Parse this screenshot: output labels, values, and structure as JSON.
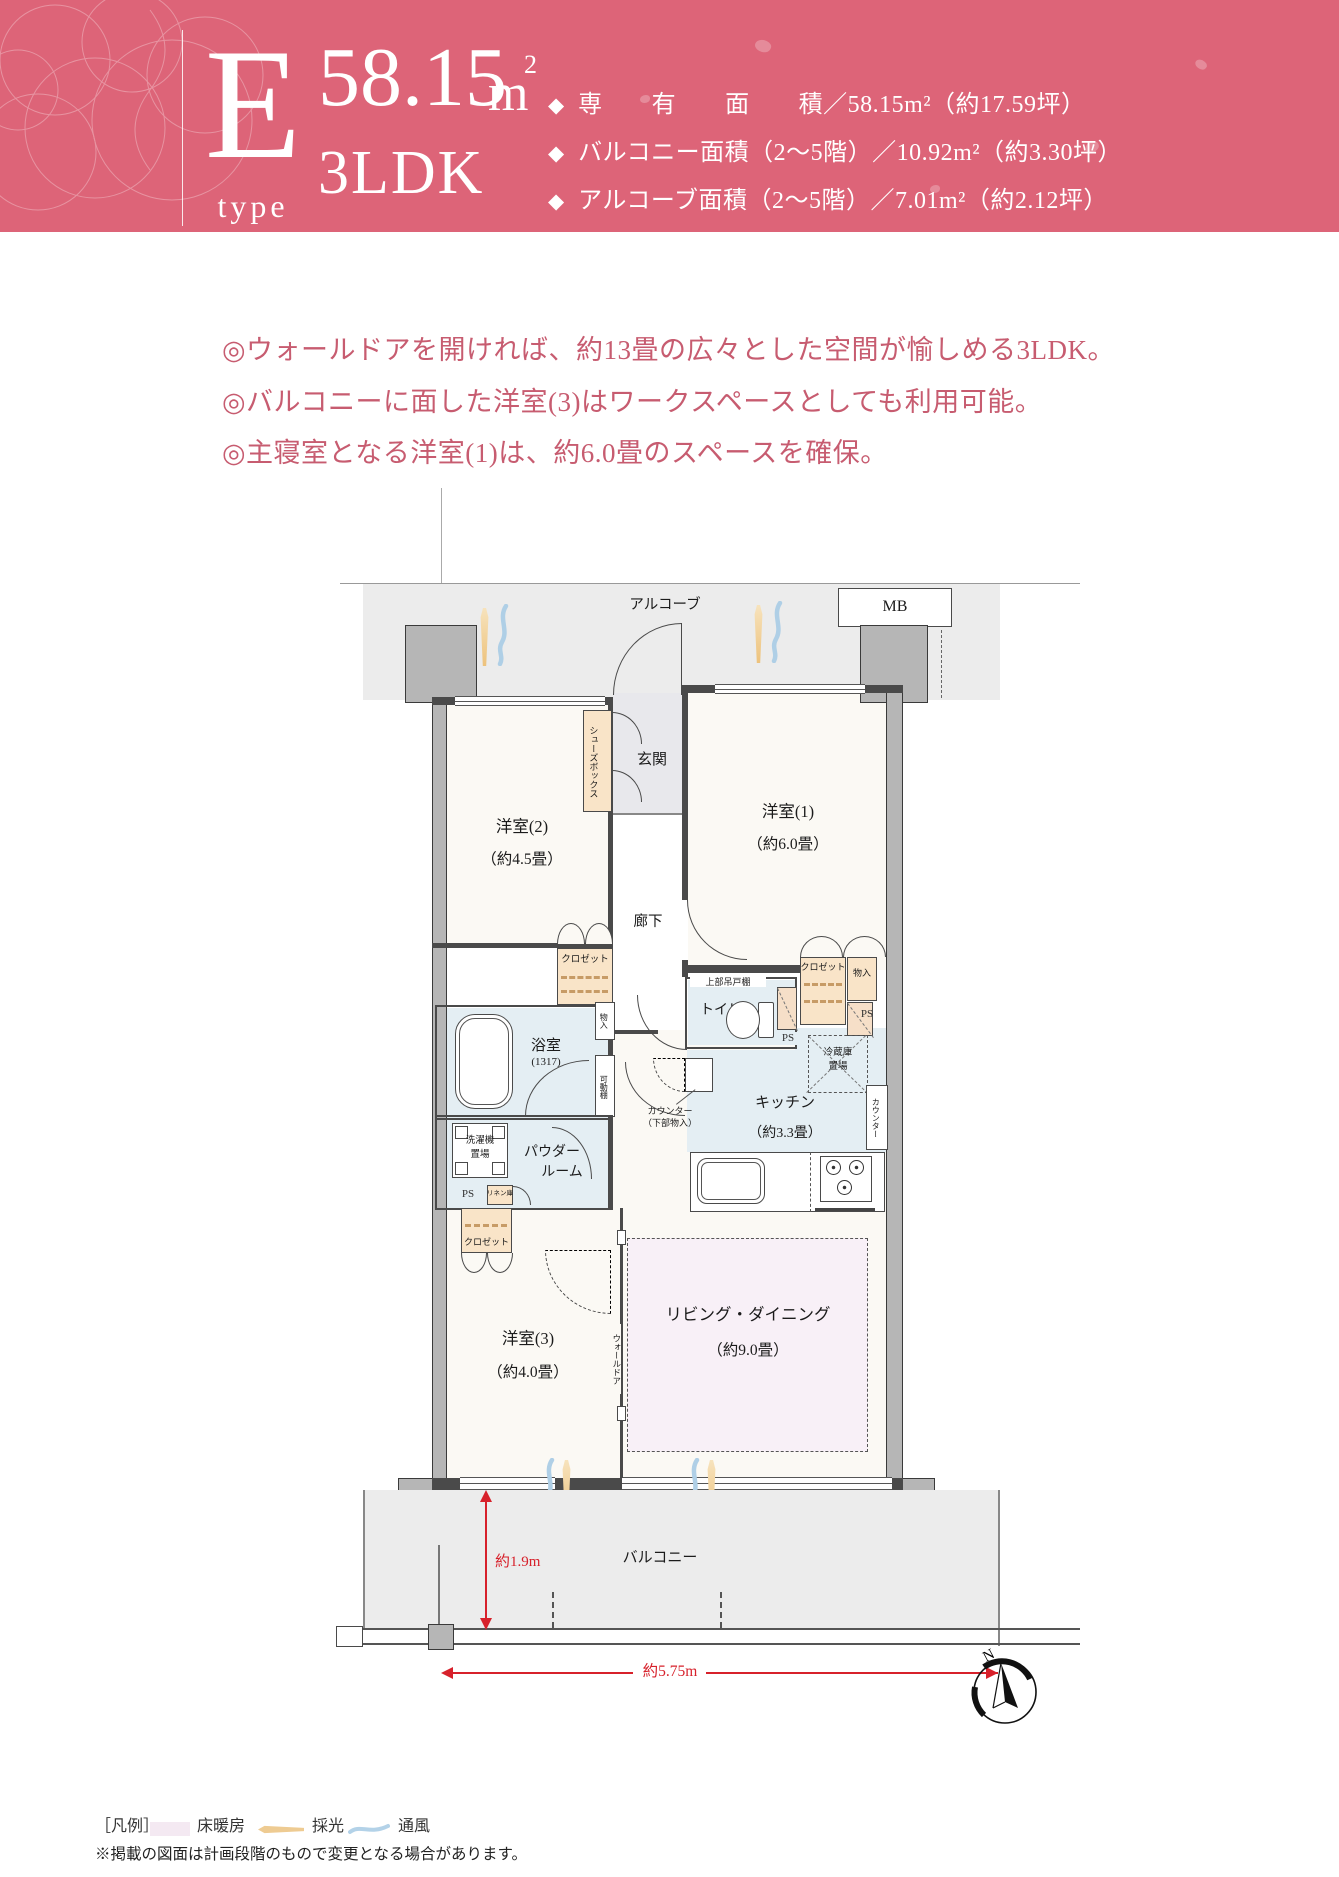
{
  "header": {
    "type_letter": "E",
    "type_word": "type",
    "area": "58.15",
    "area_unit": "m",
    "area_sup": "2",
    "layout": "3LDK",
    "bullet": "◆",
    "specs": [
      "専　　有　　面　　積／58.15m²（約17.59坪）",
      "バルコニー面積（2～5階）／10.92m²（約3.30坪）",
      "アルコーブ面積（2～5階）／7.01m²（約2.12坪）"
    ]
  },
  "features": [
    "◎ウォールドアを開ければ、約13畳の広々とした空間が愉しめる3LDK。",
    "◎バルコニーに面した洋室(3)はワークスペースとしても利用可能。",
    "◎主寝室となる洋室(1)は、約6.0畳のスペースを確保。"
  ],
  "plan": {
    "alcove": "アルコーブ",
    "mb": "MB",
    "genkan": "玄関",
    "shoes_box": "シューズボックス",
    "room2": "洋室(2)",
    "room2_size": "（約4.5畳）",
    "room1": "洋室(1)",
    "room1_size": "（約6.0畳）",
    "room3": "洋室(3)",
    "room3_size": "（約4.0畳）",
    "hall": "廊下",
    "closet": "クロゼット",
    "monoire": "物入",
    "bath": "浴室",
    "bath_size": "(1317)",
    "toilet": "トイレ",
    "upper_shelf": "上部吊戸棚",
    "ps": "PS",
    "movable_shelf": "可動棚",
    "fridge_l1": "冷蔵庫",
    "fridge_l2": "置場",
    "kitchen": "キッチン",
    "kitchen_size": "（約3.3畳）",
    "counter": "カウンター",
    "counter_note_l1": "カウンター",
    "counter_note_l2": "（下部物入）",
    "washer_l1": "洗濯機",
    "washer_l2": "置場",
    "powder_l1": "パウダー",
    "powder_l2": "ルーム",
    "linen": "リネン庫",
    "wall_door": "ウォールドア",
    "living": "リビング・ダイニング",
    "living_size": "（約9.0畳）",
    "balcony": "バルコニー",
    "dim_vertical": "約1.9m",
    "dim_horizontal": "約5.75m",
    "compass_n": "N"
  },
  "legend": {
    "title": "［凡例］",
    "floor_heating": "床暖房",
    "daylight": "採光",
    "ventilation": "通風",
    "disclaimer": "※掲載の図面は計画段階のもので変更となる場合があります。"
  },
  "colors": {
    "header_bg": "#dd6478",
    "feature_text": "#c75c70",
    "dimension_red": "#d7212b",
    "closet_fill": "#f9e4c8",
    "wet_floor": "#e4eef3",
    "floor_heating_fill": "#f8f0f7",
    "daylight_icon": "#eecb92",
    "ventilation_icon": "#afcfe6",
    "balcony_floor": "#ececec"
  }
}
